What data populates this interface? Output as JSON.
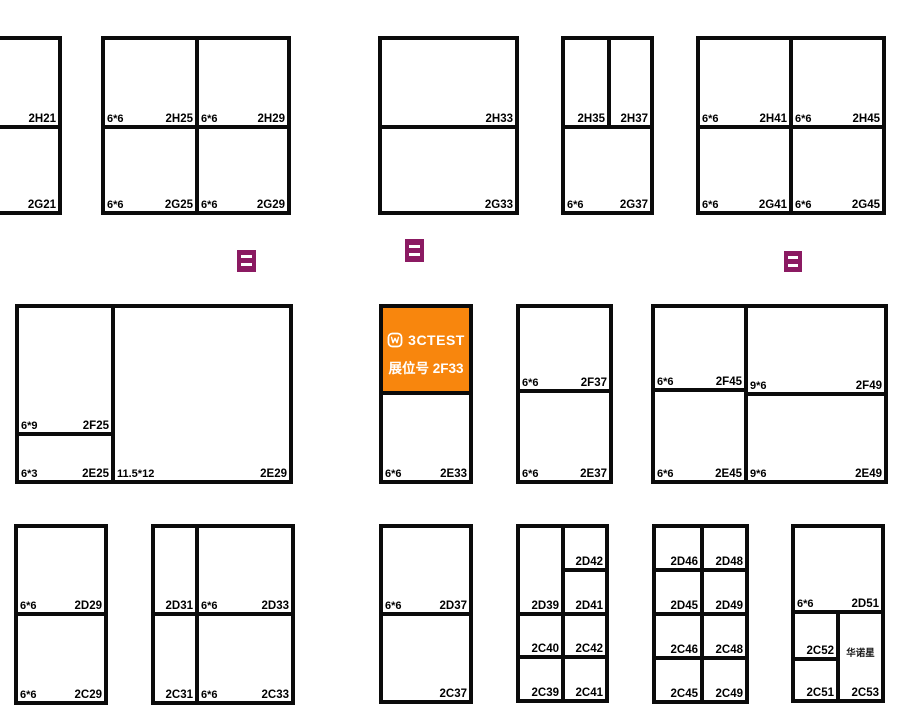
{
  "canvas": {
    "width": 900,
    "height": 716,
    "background": "#ffffff",
    "wall_color": "#0b0b0b"
  },
  "colors": {
    "highlight_orange": "#F8860D",
    "marker_purple": "#8B1A62",
    "label_black": "#000000",
    "highlight_text": "#ffffff"
  },
  "highlight_booth": {
    "logo_icon": "3ctest-logo-icon",
    "logo_text": "3CTEST",
    "booth_line": "展位号 2F33",
    "id": "2F33"
  },
  "markers": [
    {
      "x": 237,
      "y": 250,
      "w": 19,
      "h": 22
    },
    {
      "x": 405,
      "y": 239,
      "w": 19,
      "h": 23
    },
    {
      "x": 784,
      "y": 251,
      "w": 18,
      "h": 21
    }
  ],
  "booths": [
    {
      "id": "2H21",
      "x1": -30,
      "y1": 38,
      "x2": 60,
      "y2": 127
    },
    {
      "id": "2G21",
      "x1": -30,
      "y1": 127,
      "x2": 60,
      "y2": 213
    },
    {
      "id": "2H25",
      "size": "6*6",
      "x1": 103,
      "y1": 38,
      "x2": 197,
      "y2": 127
    },
    {
      "id": "2H29",
      "size": "6*6",
      "x1": 197,
      "y1": 38,
      "x2": 289,
      "y2": 127
    },
    {
      "id": "2G25",
      "size": "6*6",
      "x1": 103,
      "y1": 127,
      "x2": 197,
      "y2": 213
    },
    {
      "id": "2G29",
      "size": "6*6",
      "x1": 197,
      "y1": 127,
      "x2": 289,
      "y2": 213
    },
    {
      "id": "2H33",
      "x1": 380,
      "y1": 38,
      "x2": 517,
      "y2": 127
    },
    {
      "id": "2G33",
      "x1": 380,
      "y1": 127,
      "x2": 517,
      "y2": 213
    },
    {
      "id": "2H35",
      "x1": 563,
      "y1": 38,
      "x2": 609,
      "y2": 127
    },
    {
      "id": "2H37",
      "x1": 609,
      "y1": 38,
      "x2": 652,
      "y2": 127
    },
    {
      "id": "2G37",
      "size": "6*6",
      "x1": 563,
      "y1": 127,
      "x2": 652,
      "y2": 213
    },
    {
      "id": "2H41",
      "size": "6*6",
      "x1": 698,
      "y1": 38,
      "x2": 791,
      "y2": 127
    },
    {
      "id": "2H45",
      "size": "6*6",
      "x1": 791,
      "y1": 38,
      "x2": 884,
      "y2": 127
    },
    {
      "id": "2G41",
      "size": "6*6",
      "x1": 698,
      "y1": 127,
      "x2": 791,
      "y2": 213
    },
    {
      "id": "2G45",
      "size": "6*6",
      "x1": 791,
      "y1": 127,
      "x2": 884,
      "y2": 213
    },
    {
      "id": "2F25",
      "size": "6*9",
      "x1": 17,
      "y1": 306,
      "x2": 113,
      "y2": 434
    },
    {
      "id": "2E25",
      "size": "6*3",
      "x1": 17,
      "y1": 434,
      "x2": 113,
      "y2": 482
    },
    {
      "id": "2E29",
      "size": "11.5*12",
      "x1": 113,
      "y1": 306,
      "x2": 291,
      "y2": 482
    },
    {
      "id": "2F33",
      "highlight": true,
      "x1": 381,
      "y1": 306,
      "x2": 471,
      "y2": 393
    },
    {
      "id": "2E33",
      "size": "6*6",
      "x1": 381,
      "y1": 393,
      "x2": 471,
      "y2": 482
    },
    {
      "id": "2F37",
      "size": "6*6",
      "x1": 518,
      "y1": 306,
      "x2": 611,
      "y2": 391
    },
    {
      "id": "2E37",
      "size": "6*6",
      "x1": 518,
      "y1": 391,
      "x2": 611,
      "y2": 482
    },
    {
      "id": "2F45",
      "size": "6*6",
      "x1": 653,
      "y1": 306,
      "x2": 746,
      "y2": 390
    },
    {
      "id": "2F49",
      "size": "9*6",
      "x1": 746,
      "y1": 306,
      "x2": 886,
      "y2": 394
    },
    {
      "id": "2E45",
      "size": "6*6",
      "x1": 653,
      "y1": 390,
      "x2": 746,
      "y2": 482
    },
    {
      "id": "2E49",
      "size": "9*6",
      "x1": 746,
      "y1": 394,
      "x2": 886,
      "y2": 482
    },
    {
      "id": "2D29",
      "size": "6*6",
      "x1": 16,
      "y1": 526,
      "x2": 106,
      "y2": 614
    },
    {
      "id": "2C29",
      "size": "6*6",
      "x1": 16,
      "y1": 614,
      "x2": 106,
      "y2": 703
    },
    {
      "id": "2D31",
      "x1": 153,
      "y1": 526,
      "x2": 197,
      "y2": 614
    },
    {
      "id": "2D33",
      "size": "6*6",
      "x1": 197,
      "y1": 526,
      "x2": 293,
      "y2": 614
    },
    {
      "id": "2C31",
      "x1": 153,
      "y1": 614,
      "x2": 197,
      "y2": 703
    },
    {
      "id": "2C33",
      "size": "6*6",
      "x1": 197,
      "y1": 614,
      "x2": 293,
      "y2": 703
    },
    {
      "id": "2D37",
      "size": "6*6",
      "x1": 381,
      "y1": 526,
      "x2": 471,
      "y2": 614
    },
    {
      "id": "2C37",
      "x1": 381,
      "y1": 614,
      "x2": 471,
      "y2": 702
    },
    {
      "id": "2D39",
      "x1": 518,
      "y1": 526,
      "x2": 563,
      "y2": 614
    },
    {
      "id": "2D42",
      "x1": 563,
      "y1": 526,
      "x2": 607,
      "y2": 570
    },
    {
      "id": "2D41",
      "x1": 563,
      "y1": 570,
      "x2": 607,
      "y2": 614
    },
    {
      "id": "2C40",
      "x1": 518,
      "y1": 614,
      "x2": 563,
      "y2": 657
    },
    {
      "id": "2C42",
      "x1": 563,
      "y1": 614,
      "x2": 607,
      "y2": 657
    },
    {
      "id": "2C39",
      "x1": 518,
      "y1": 657,
      "x2": 563,
      "y2": 701
    },
    {
      "id": "2C41",
      "x1": 563,
      "y1": 657,
      "x2": 607,
      "y2": 701
    },
    {
      "id": "2D46",
      "x1": 654,
      "y1": 526,
      "x2": 702,
      "y2": 570
    },
    {
      "id": "2D48",
      "x1": 702,
      "y1": 526,
      "x2": 747,
      "y2": 570
    },
    {
      "id": "2D45",
      "x1": 654,
      "y1": 570,
      "x2": 702,
      "y2": 614
    },
    {
      "id": "2D49",
      "x1": 702,
      "y1": 570,
      "x2": 747,
      "y2": 614
    },
    {
      "id": "2C46",
      "x1": 654,
      "y1": 614,
      "x2": 702,
      "y2": 658
    },
    {
      "id": "2C48",
      "x1": 702,
      "y1": 614,
      "x2": 747,
      "y2": 658
    },
    {
      "id": "2C45",
      "x1": 654,
      "y1": 658,
      "x2": 702,
      "y2": 702
    },
    {
      "id": "2C49",
      "x1": 702,
      "y1": 658,
      "x2": 747,
      "y2": 702
    },
    {
      "id": "2D51",
      "size": "6*6",
      "x1": 793,
      "y1": 526,
      "x2": 883,
      "y2": 612
    },
    {
      "id": "2C52",
      "x1": 793,
      "y1": 612,
      "x2": 838,
      "y2": 659
    },
    {
      "id": "2C51",
      "x1": 793,
      "y1": 659,
      "x2": 838,
      "y2": 701
    },
    {
      "id": "2C53",
      "note": "华诺星",
      "x1": 838,
      "y1": 612,
      "x2": 883,
      "y2": 701
    }
  ]
}
